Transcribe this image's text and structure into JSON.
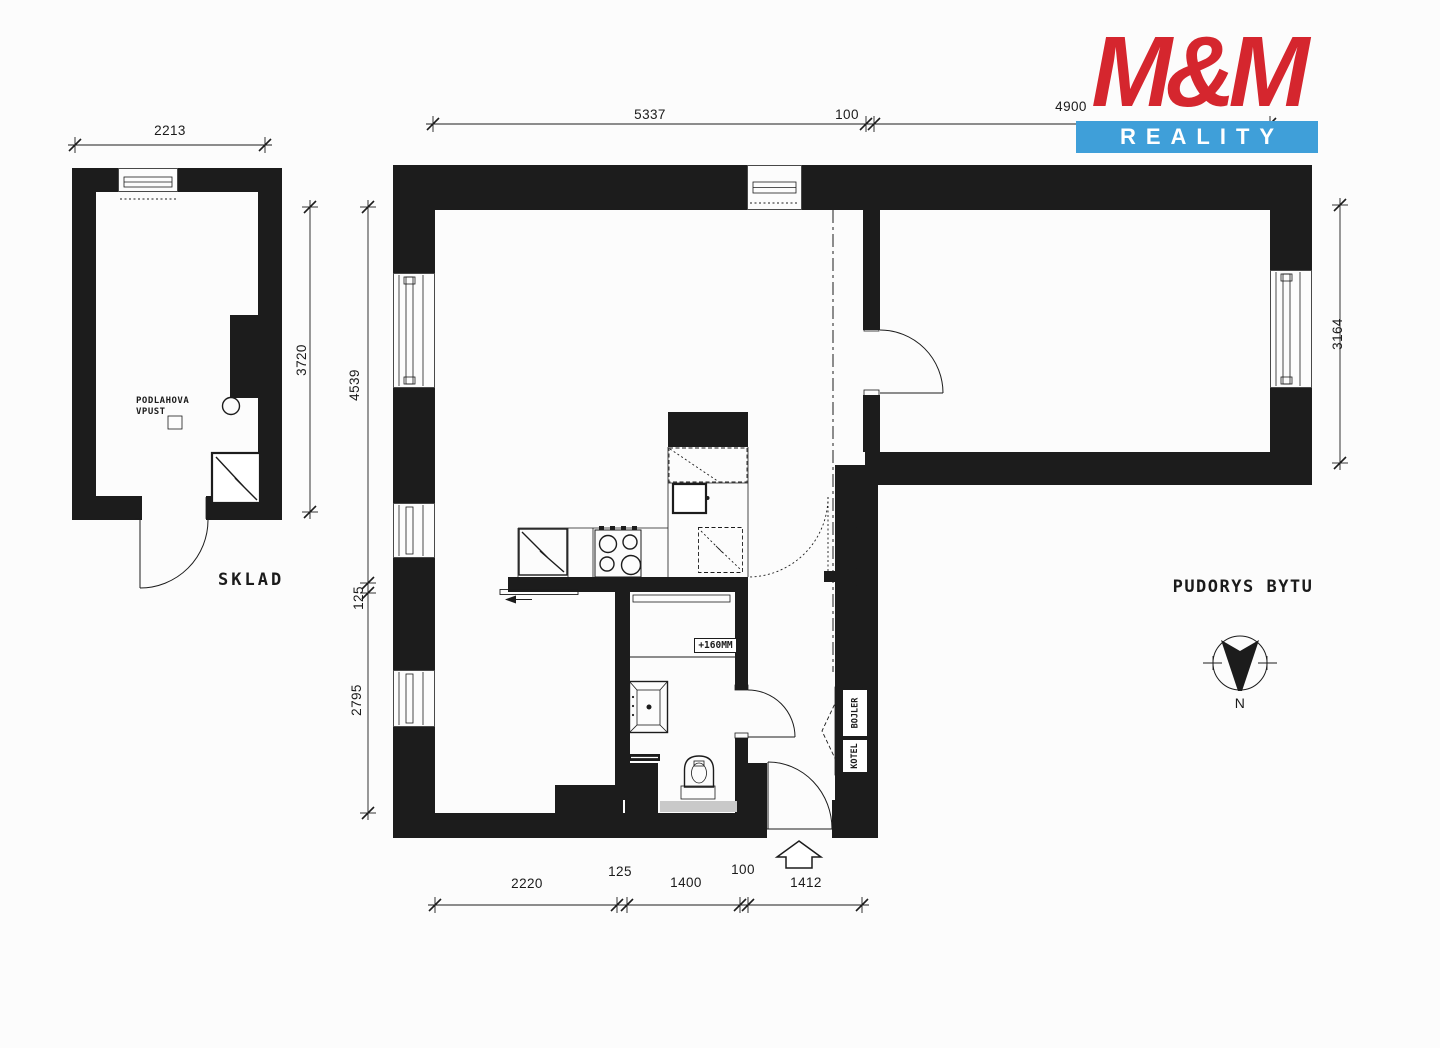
{
  "colors": {
    "wall": "#1c1c1c",
    "paper": "#fcfcfc",
    "logo_red": "#d5262e",
    "logo_blue": "#3f9fd9",
    "threshold_gray": "#c9c9c9"
  },
  "logo": {
    "brand": "M&M",
    "tagline": "REALITY"
  },
  "sklad": {
    "room_label": "SKLAD",
    "floor_drain_label_line1": "PODLAHOVA",
    "floor_drain_label_line2": "VPUST",
    "dim_top": "2213",
    "dim_right": "3720"
  },
  "apartment": {
    "plan_label": "PUDORYS BYTU",
    "bath_step_label": "+160MM",
    "boiler_label": "KOTEL",
    "water_heater_label": "BOJLER",
    "dims": {
      "top": [
        "5337",
        "100",
        "4900"
      ],
      "left": [
        "4539",
        "125",
        "2795"
      ],
      "right": [
        "3164"
      ],
      "bottom": [
        "2220",
        "125",
        "1400",
        "100",
        "1412"
      ]
    }
  },
  "compass": {
    "north_label": "N"
  }
}
